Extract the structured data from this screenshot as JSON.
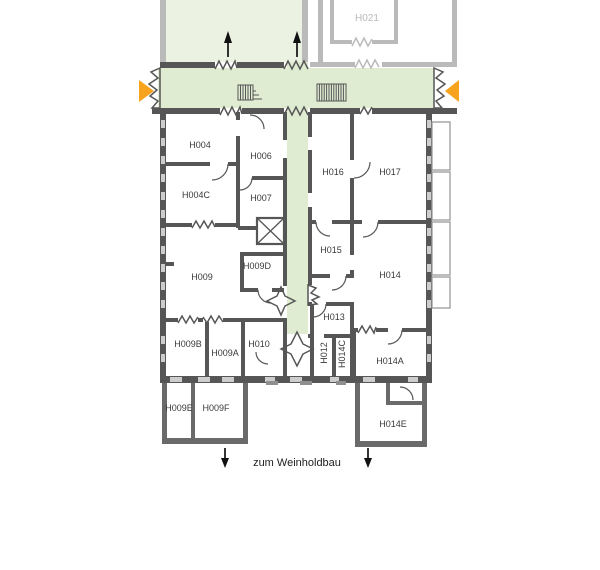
{
  "colors": {
    "corridor_green": "#dfecd2",
    "hall_green": "#ebf2e1",
    "accent_orange": "#f7a31e",
    "wall_dark": "#565656",
    "wall_light": "#bababa",
    "label_dark": "#3a3a3a",
    "label_light": "#bababa"
  },
  "rooms": {
    "H021": "H021",
    "H004": "H004",
    "H006": "H006",
    "H004C": "H004C",
    "H007": "H007",
    "H016": "H016",
    "H017": "H017",
    "H009": "H009",
    "H009D": "H009D",
    "H015": "H015",
    "H014": "H014",
    "H013": "H013",
    "H009B": "H009B",
    "H009A": "H009A",
    "H010": "H010",
    "H012": "H012",
    "H014C": "H014C",
    "H014A": "H014A",
    "H009E": "H009E",
    "H009F": "H009F",
    "H014E": "H014E"
  },
  "footer": {
    "exit_label": "zum Weinholdbau"
  },
  "icons": {
    "up_arrow": "↑",
    "down_arrow": "↓",
    "exit_right": "▶",
    "exit_left": "◀",
    "stairs": "stairs-hatch",
    "external_stairs": "stairs-hatch",
    "elevator": "crossed-box"
  }
}
